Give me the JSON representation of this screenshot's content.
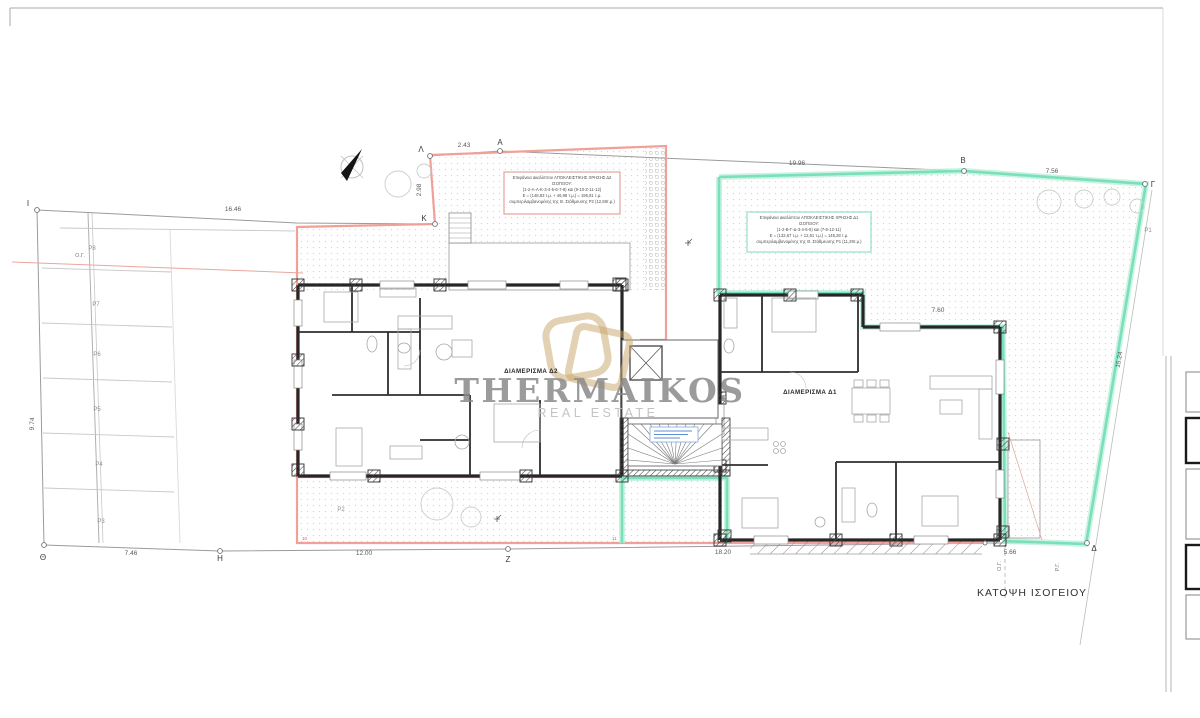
{
  "sheet": {
    "view_title": "ΚΑΤΟΨΗ ΙΣΟΓΕΙΟΥ"
  },
  "watermark": {
    "brand": "THERMAIKOS",
    "subtitle": "REAL ESTATE"
  },
  "apartments": {
    "d2_label": "ΔΙΑΜΕΡΙΣΜΑ  Δ2",
    "d1_label": "ΔΙΑΜΕΡΙΣΜΑ  Δ1"
  },
  "notes": {
    "d2": {
      "l1": "Επιφάνεια ακαλύπτου ΑΠΟΚΛΕΙΣΤΙΚΗΣ ΧΡΗΣΗΣ Δ2",
      "l2": "ΙΣΟΓΕΙΟΥ:",
      "l3": "(1-2-Α-Λ-Κ-3-4-5-6-7-8) και (9-10-Ζ-11-12)",
      "l4": "Ε = (148,83 τ.μ. + 46,98 τ.μ.) = 195,81 τ.μ.",
      "l5": "συμπεριλαμβανομένης της Θ. Στάθμευσης P2 (12,68τ.μ.)"
    },
    "d1": {
      "l1": "Επιφάνεια ακαλύπτου ΑΠΟΚΛΕΙΣΤΙΚΗΣ ΧΡΗΣΗΣ Δ1",
      "l2": "ΙΣΟΓΕΙΟΥ:",
      "l3": "(1-2-Β-Γ-Δ-3-4-5-6) και (7-8-12-11)",
      "l4": "Ε = (132,67 τ.μ. + 12,61 τ.μ.) = 145,28 τ.μ.",
      "l5": "συμπεριλαμβανομένης της Θ. Στάθμευσης P1 (11,29τ.μ.)"
    }
  },
  "points": {
    "i": "Ι",
    "lam": "Λ",
    "a": "Α",
    "k": "Κ",
    "b": "Β",
    "g": "Γ",
    "th": "Θ",
    "h": "Η",
    "z": "Ζ",
    "d": "Δ"
  },
  "dims": {
    "top_left": "2.43",
    "left_vert": "2.98",
    "top_mid": "19.96",
    "top_right": "7.56",
    "west": "16.46",
    "west_vert": "9.74",
    "bottom_1": "7.46",
    "bottom_2": "12.00",
    "bottom_3": "18.20",
    "bottom_4": "5.66",
    "east_slope": "15.24",
    "court_width": "7.60"
  },
  "parking": {
    "p8": "P8",
    "p7": "P7",
    "p6": "P6",
    "p5": "P5",
    "p4": "P4",
    "p3": "P3",
    "p2": "P2",
    "p1": "P1"
  },
  "ref_lines": {
    "og_west": "Ο.Γ.",
    "og_south": "Ο.Γ.",
    "rg_south": "Ρ.Γ."
  },
  "vertex_marks": {
    "m10": "10",
    "m11": "11"
  },
  "colors": {
    "boundary_d2": "#f0a097",
    "boundary_d1": "#79e0ba",
    "watermark_gray": "#8a8a8a",
    "logo_gold": "#c7a468",
    "wall": "#262626"
  }
}
